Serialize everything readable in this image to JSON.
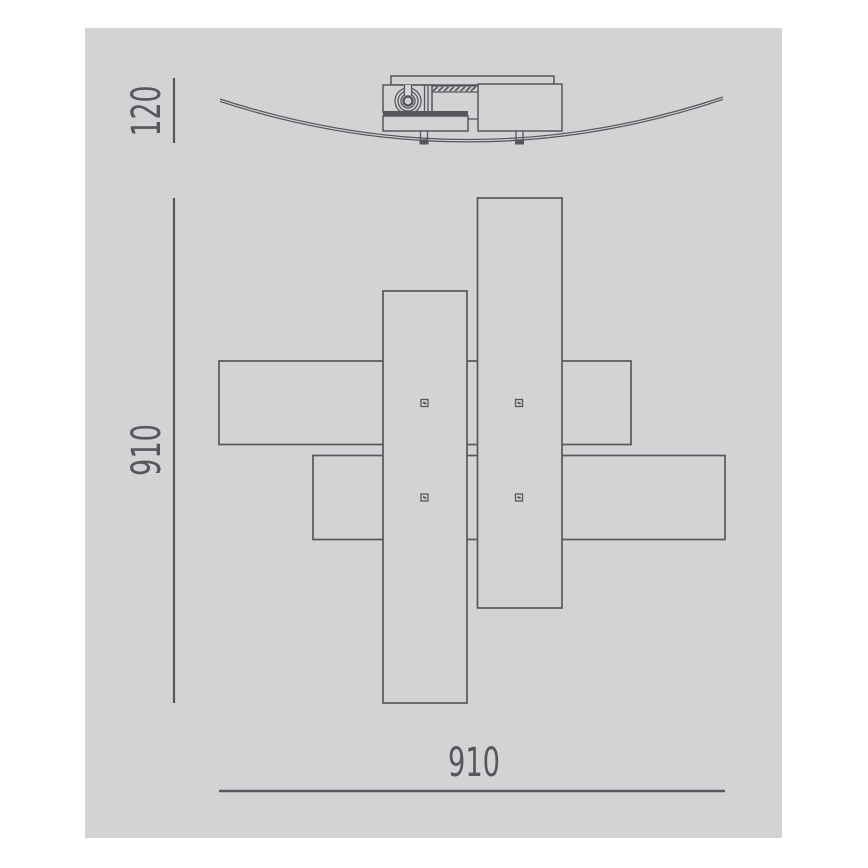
{
  "page": {
    "background": "#ffffff"
  },
  "drawing": {
    "canvas_background": "#d2d3d5",
    "line_color": "#55575a",
    "dark_fill_color": "#55575a",
    "labels": {
      "fixture_height": "120",
      "plan_depth": "910",
      "plan_width": "910"
    }
  }
}
